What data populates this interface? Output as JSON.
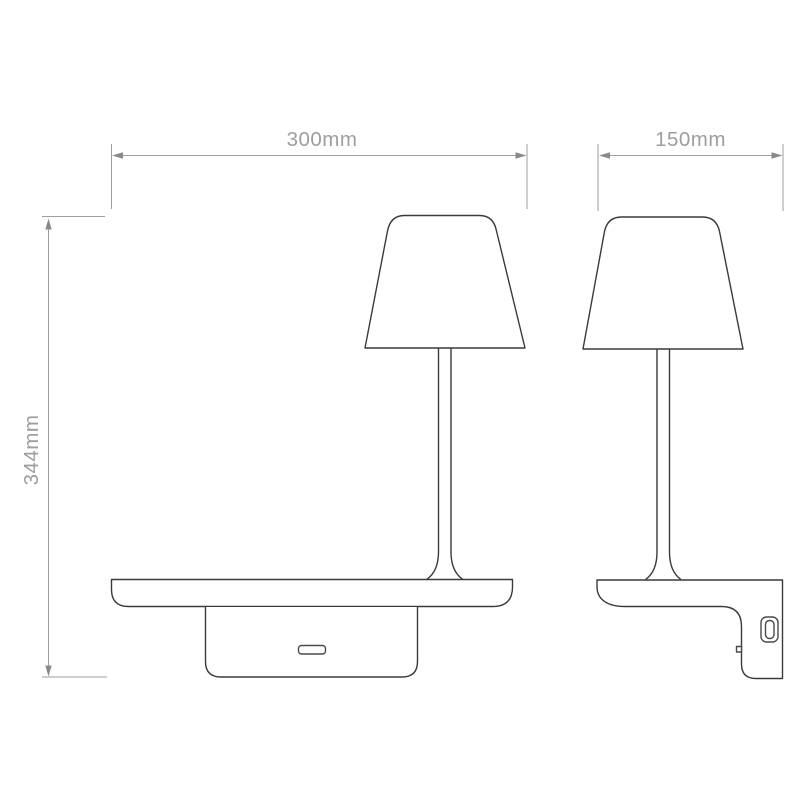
{
  "drawing": {
    "labels": {
      "width": "300mm",
      "depth": "150mm",
      "height": "344mm"
    },
    "colors": {
      "background": "#ffffff",
      "outline": "#3a3a3a",
      "dimension_line": "#9e9e9e",
      "dimension_text": "#9e9e9e",
      "arrow": "#8a8a8a"
    },
    "icons": {
      "dimension_arrow": "filled-triangle"
    }
  }
}
